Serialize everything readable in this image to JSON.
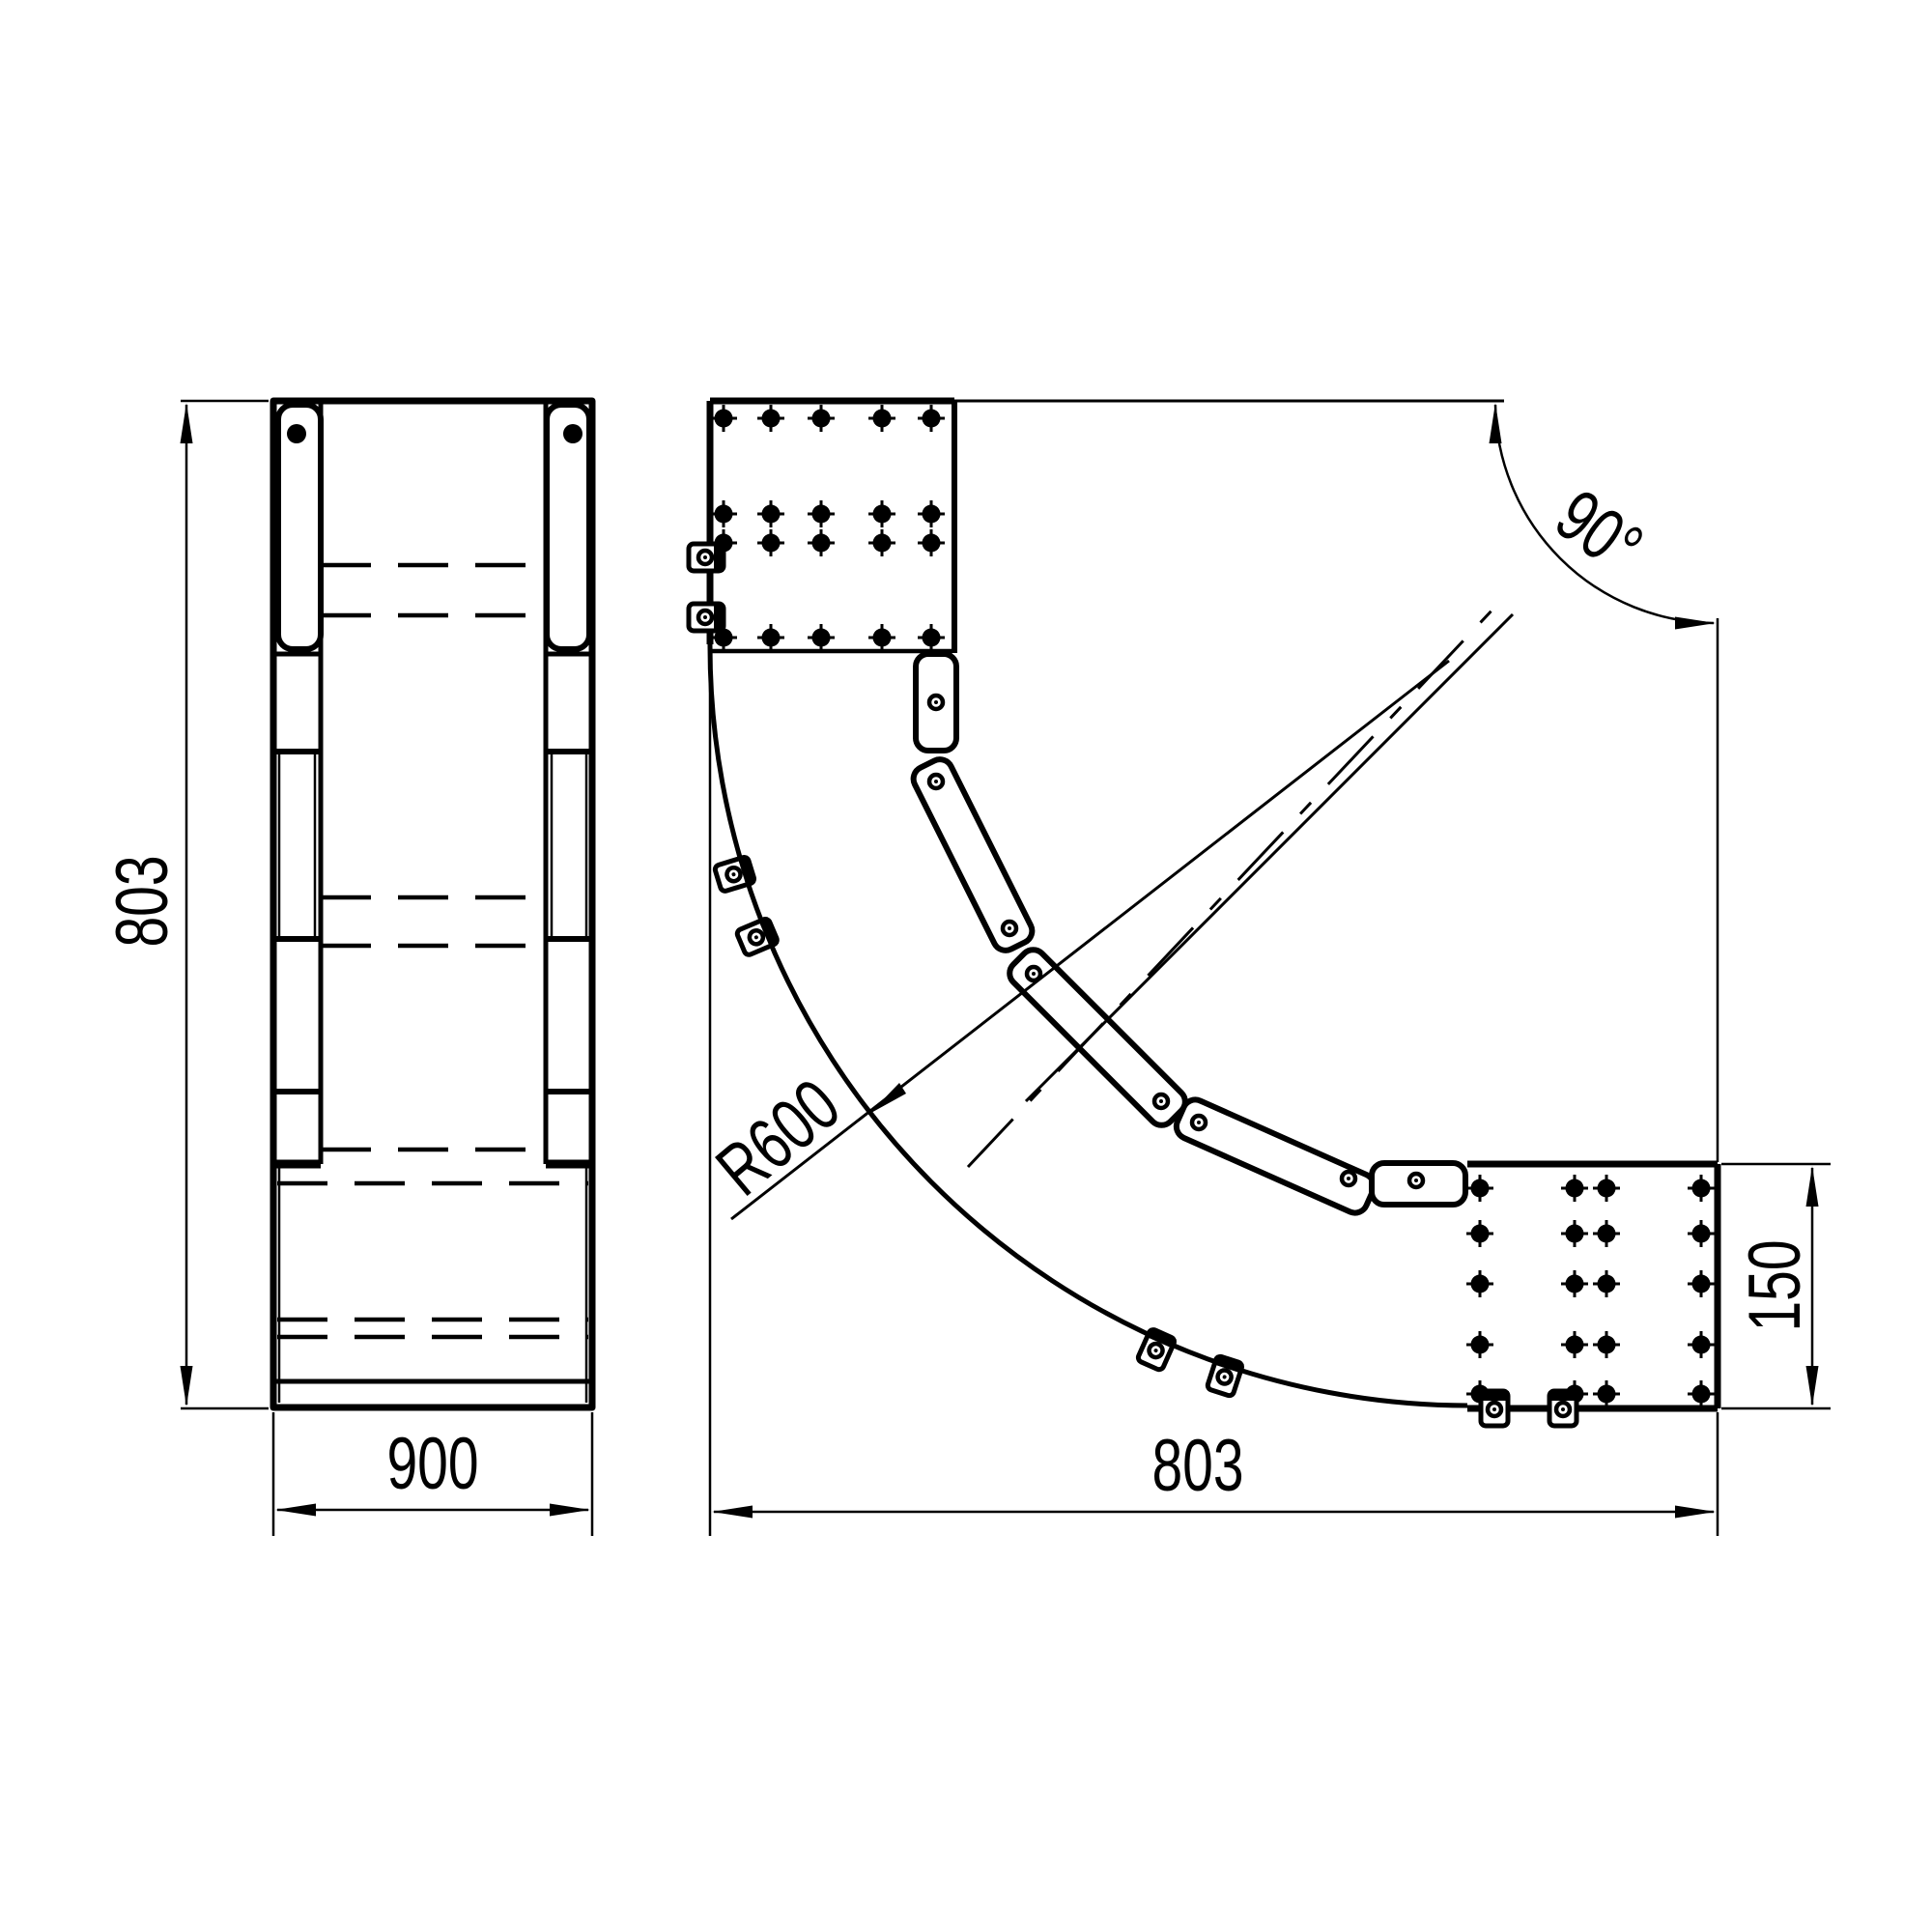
{
  "drawing": {
    "kind": "technical-drawing",
    "subject": "cable tray 90 degree horizontal bend, two views",
    "colors": {
      "line": "#000000",
      "background": "#ffffff"
    },
    "side_view": {
      "dims": {
        "height_label": "803",
        "width_label": "900"
      }
    },
    "plan_view": {
      "dims": {
        "width_label": "803",
        "flange_label": "150",
        "radius_label": "R600",
        "angle_label": "90°"
      }
    }
  }
}
